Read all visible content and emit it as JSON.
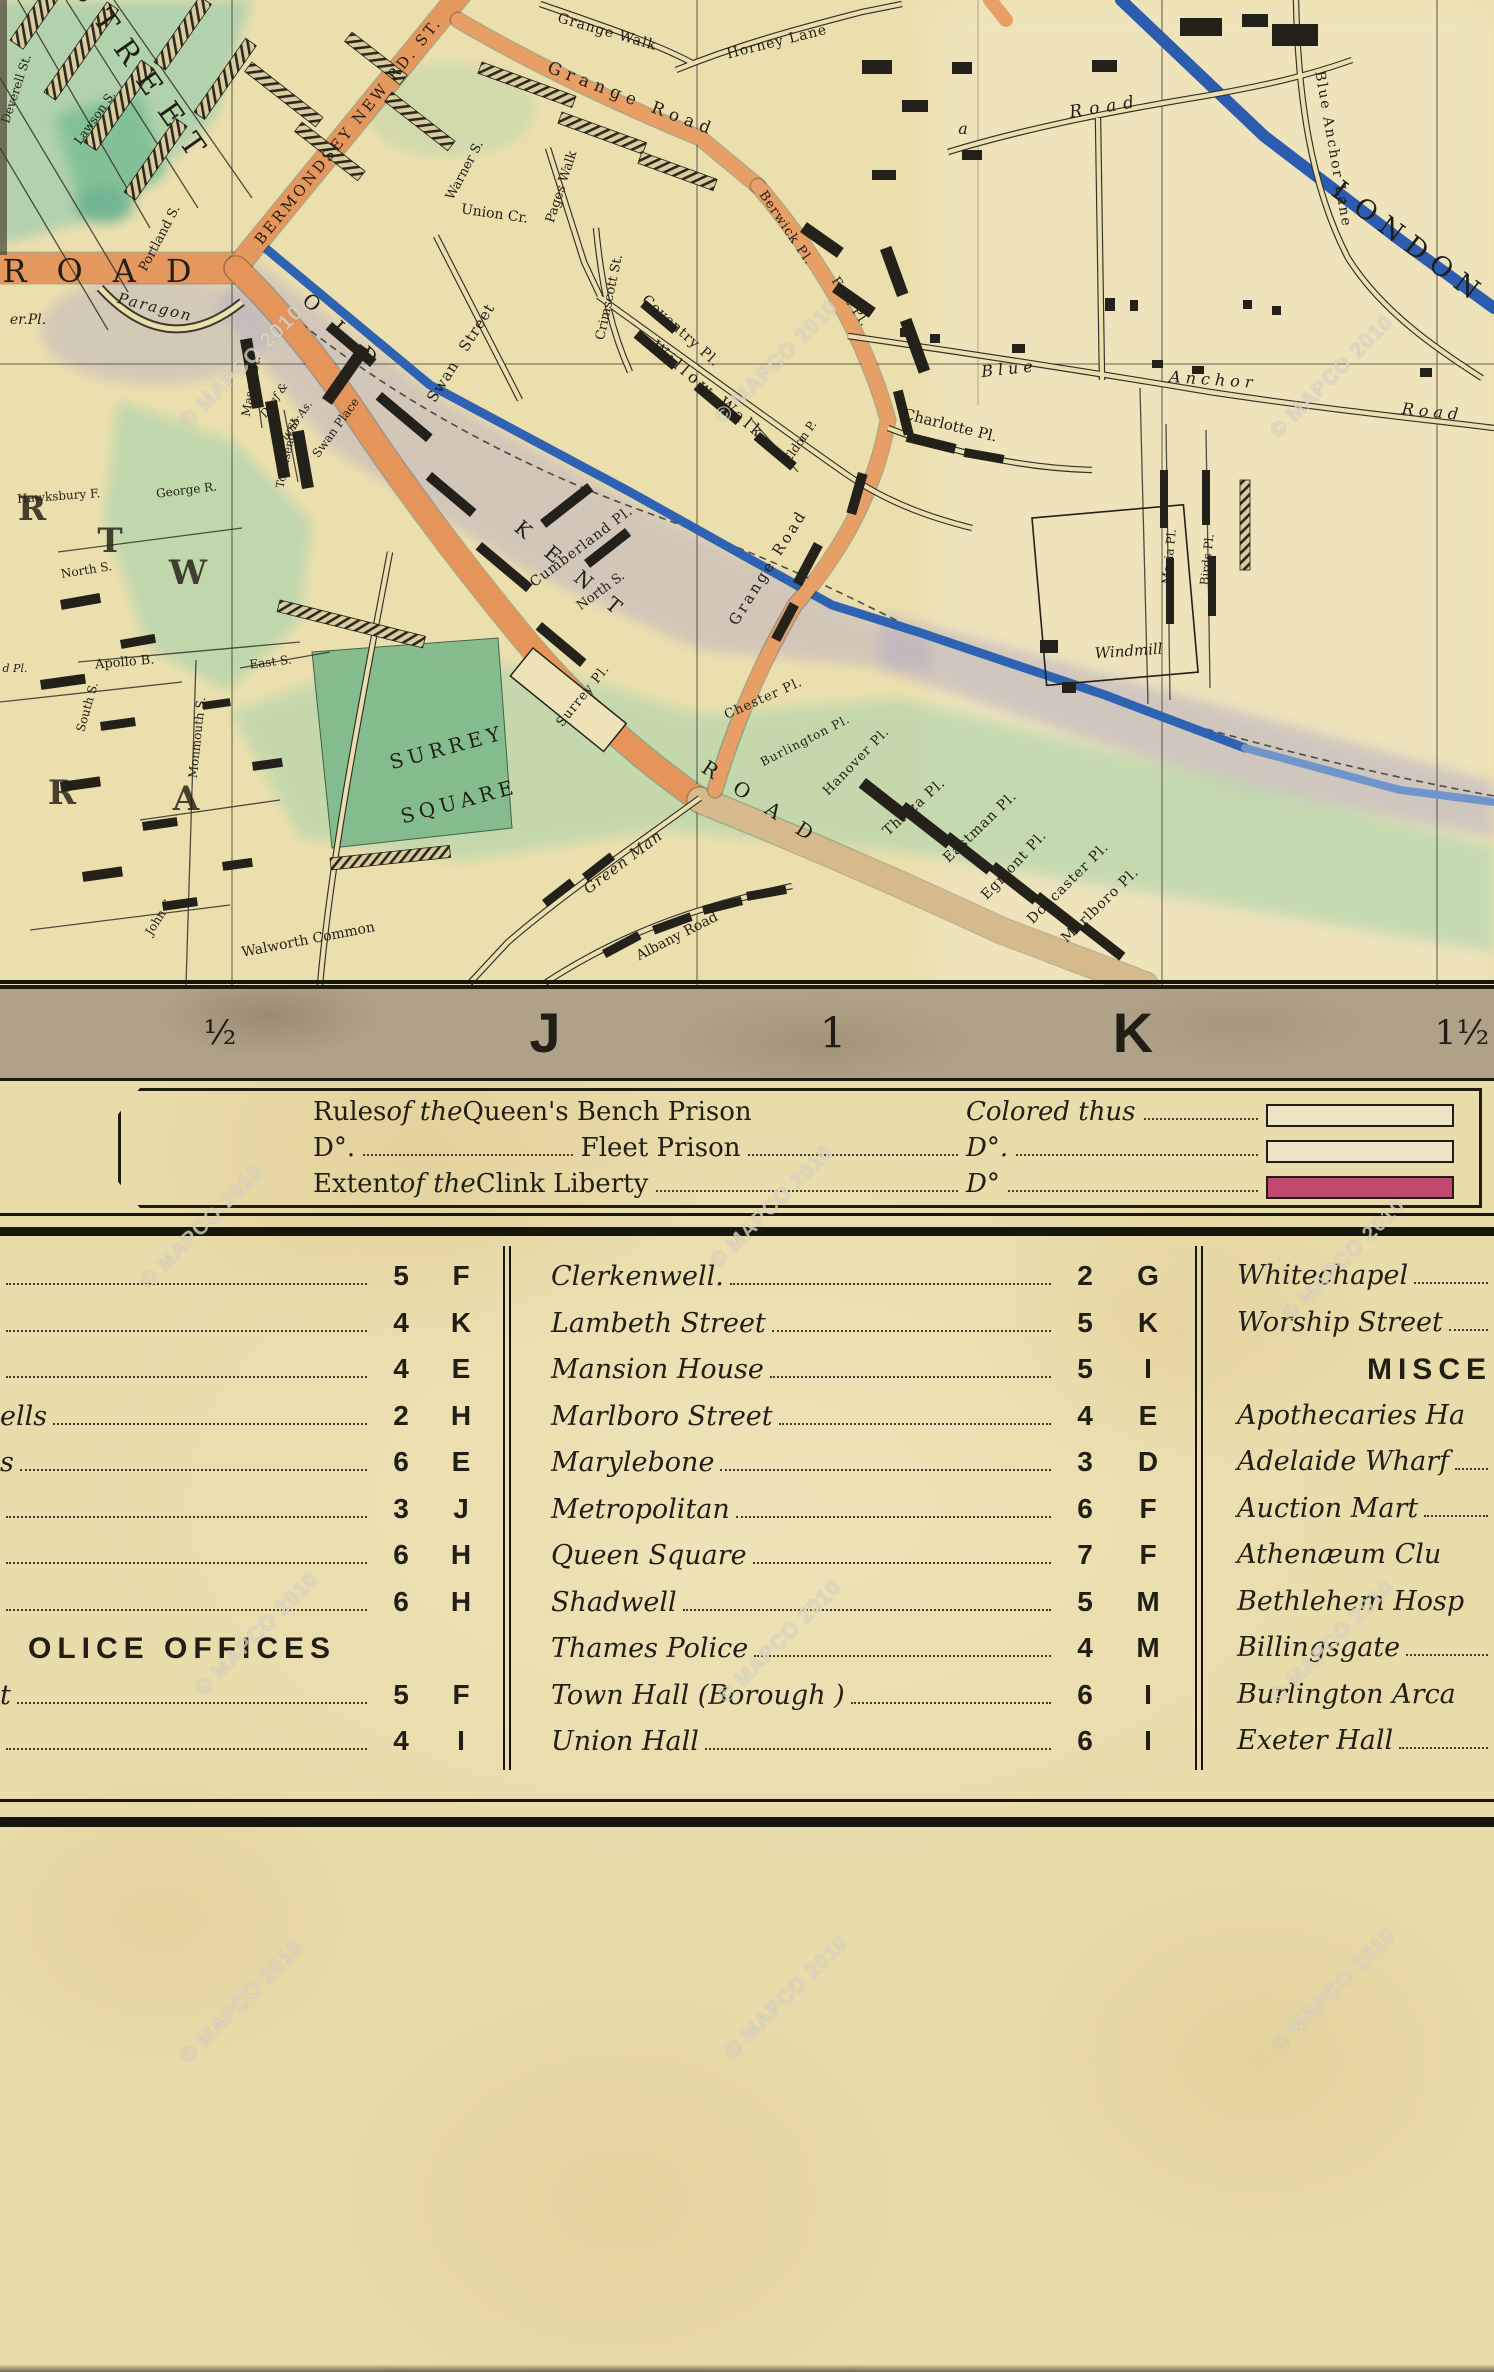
{
  "watermark_text": "© MAPCO 2010",
  "watermarks": [
    {
      "x": 160,
      "y": 355
    },
    {
      "x": 695,
      "y": 350
    },
    {
      "x": 1250,
      "y": 365
    },
    {
      "x": 120,
      "y": 1215
    },
    {
      "x": 690,
      "y": 1195
    },
    {
      "x": 1262,
      "y": 1248
    },
    {
      "x": 175,
      "y": 1622
    },
    {
      "x": 698,
      "y": 1630
    },
    {
      "x": 1250,
      "y": 1630
    },
    {
      "x": 160,
      "y": 1990
    },
    {
      "x": 705,
      "y": 1985
    },
    {
      "x": 1252,
      "y": 1978
    }
  ],
  "colors": {
    "paper": "#e9dcab",
    "map_paper": "#ecdfae",
    "road_orange": "#e5985e",
    "road_tan": "#d6ba8c",
    "canal_blue": "#2e62b2",
    "green": "#b5d6ab",
    "lavender": "#b7afc2",
    "band_gray": "#b0a288",
    "clink_crimson": "#c1486e",
    "ink": "#211e15"
  },
  "map": {
    "labels": [
      [
        "STREET",
        135,
        80,
        55,
        30,
        16,
        ""
      ],
      [
        "ROAD",
        112,
        282,
        0,
        32,
        30,
        ""
      ],
      [
        "er.Pl.",
        28,
        324,
        0,
        14,
        0,
        "it"
      ],
      [
        "Paragon",
        154,
        312,
        14,
        15,
        2,
        "it"
      ],
      [
        "Union Cr.",
        494,
        218,
        8,
        14,
        0,
        ""
      ],
      [
        "Warner S.",
        468,
        172,
        -62,
        13,
        0,
        ""
      ],
      [
        "Portland S.",
        163,
        240,
        -62,
        13,
        0,
        ""
      ],
      [
        "Lawson S.",
        98,
        120,
        -55,
        12,
        0,
        ""
      ],
      [
        "Deverell St.",
        20,
        90,
        -72,
        12,
        0,
        ""
      ],
      [
        "BERMONDSEY NEW RD. ST.",
        352,
        134,
        -51,
        15,
        3,
        ""
      ],
      [
        "Grange Walk",
        606,
        36,
        16,
        14,
        1,
        ""
      ],
      [
        "Horney Lane",
        778,
        46,
        -14,
        14,
        1,
        ""
      ],
      [
        "Grange Road",
        630,
        104,
        21,
        17,
        6,
        ""
      ],
      [
        "Pages Walk",
        565,
        188,
        -72,
        13,
        0,
        ""
      ],
      [
        "Swan",
        447,
        384,
        -58,
        15,
        1,
        ""
      ],
      [
        "Street",
        481,
        330,
        -58,
        15,
        1,
        ""
      ],
      [
        "Crimscott St.",
        613,
        298,
        -78,
        13,
        0,
        ""
      ],
      [
        "Coventry Pl.",
        678,
        334,
        42,
        14,
        1,
        ""
      ],
      [
        "Willow Walk",
        705,
        394,
        40,
        16,
        4,
        ""
      ],
      [
        "Berwick Pl.",
        783,
        230,
        56,
        13,
        1,
        ""
      ],
      [
        "Fort Pl.",
        847,
        304,
        56,
        13,
        1,
        ""
      ],
      [
        "Grange Road",
        772,
        570,
        -58,
        15,
        3,
        ""
      ],
      [
        "Cumberland Pl.",
        584,
        550,
        -37,
        14,
        1,
        ""
      ],
      [
        "North S.",
        603,
        594,
        -36,
        13,
        0,
        ""
      ],
      [
        "Eldon P.",
        803,
        444,
        -55,
        12,
        0,
        ""
      ],
      [
        "a",
        963,
        134,
        0,
        16,
        0,
        "it"
      ],
      [
        "Road",
        1106,
        112,
        -9,
        17,
        7,
        "it"
      ],
      [
        "Blue",
        1010,
        374,
        -6,
        16,
        5,
        "it"
      ],
      [
        "Anchor",
        1213,
        385,
        4,
        16,
        5,
        "it"
      ],
      [
        "Road",
        1432,
        417,
        6,
        16,
        5,
        "it"
      ],
      [
        "Blue Anchor Lane",
        1329,
        150,
        80,
        14,
        2,
        ""
      ],
      [
        "LONDON",
        1404,
        250,
        37,
        27,
        9,
        ""
      ],
      [
        "Charlotte Pl.",
        949,
        430,
        14,
        15,
        0,
        ""
      ],
      [
        "Maria Pl.",
        1173,
        557,
        -84,
        12,
        0,
        ""
      ],
      [
        "Birds Pl.",
        1211,
        560,
        -84,
        12,
        0,
        ""
      ],
      [
        "Windmill",
        1129,
        656,
        -4,
        15,
        0,
        "it"
      ],
      [
        "Mason St.",
        255,
        387,
        -80,
        12,
        0,
        ""
      ],
      [
        "Deaf &",
        277,
        402,
        -55,
        11,
        0,
        "it"
      ],
      [
        "Dumb As.",
        297,
        426,
        -55,
        11,
        0,
        "it"
      ],
      [
        "Townsend St.",
        291,
        452,
        -78,
        11,
        0,
        ""
      ],
      [
        "Swan Place",
        339,
        430,
        -54,
        12,
        0,
        ""
      ],
      [
        "OLD",
        344,
        342,
        43,
        20,
        24,
        ""
      ],
      [
        "KENT",
        573,
        580,
        40,
        20,
        24,
        ""
      ],
      [
        "ROAD",
        763,
        812,
        33,
        20,
        22,
        ""
      ],
      [
        "Surrey Pl.",
        586,
        698,
        -51,
        13,
        1,
        ""
      ],
      [
        "SURREY",
        449,
        754,
        -15,
        20,
        5,
        ""
      ],
      [
        "SQUARE",
        461,
        808,
        -15,
        20,
        5,
        ""
      ],
      [
        "Green Man",
        626,
        866,
        -37,
        15,
        1,
        "it"
      ],
      [
        "Chester Pl.",
        765,
        702,
        -24,
        13,
        1,
        ""
      ],
      [
        "Burlington Pl.",
        807,
        744,
        -27,
        12,
        1,
        ""
      ],
      [
        "Hanover Pl.",
        859,
        764,
        -46,
        13,
        1,
        ""
      ],
      [
        "Thirza Pl.",
        917,
        810,
        -42,
        14,
        1,
        ""
      ],
      [
        "Eastman Pl.",
        983,
        830,
        -44,
        14,
        1,
        ""
      ],
      [
        "Egmont Pl.",
        1017,
        868,
        -47,
        14,
        1,
        ""
      ],
      [
        "Doncaster Pl.",
        1071,
        886,
        -45,
        14,
        1,
        ""
      ],
      [
        "Marlboro Pl.",
        1103,
        908,
        -44,
        14,
        1,
        ""
      ],
      [
        "Albany Road",
        679,
        940,
        -27,
        14,
        0,
        ""
      ],
      [
        "Walworth Common",
        309,
        944,
        -11,
        14,
        0,
        ""
      ],
      [
        "Monmouth S.",
        201,
        738,
        -84,
        12,
        0,
        ""
      ],
      [
        "South S.",
        91,
        708,
        -74,
        12,
        0,
        ""
      ],
      [
        "Apollo B.",
        125,
        666,
        -5,
        13,
        0,
        ""
      ],
      [
        "John S.",
        163,
        918,
        -58,
        12,
        0,
        ""
      ],
      [
        "North S.",
        87,
        574,
        -9,
        12,
        0,
        ""
      ],
      [
        "East S.",
        271,
        666,
        -7,
        12,
        0,
        ""
      ],
      [
        "d Pl.",
        15,
        672,
        0,
        11,
        0,
        "it"
      ],
      [
        "Hawksbury F.",
        59,
        500,
        -4,
        12,
        0,
        ""
      ],
      [
        "George R.",
        187,
        494,
        -7,
        12,
        0,
        ""
      ],
      [
        "R",
        32,
        520,
        0,
        34,
        0,
        "big"
      ],
      [
        "T",
        110,
        552,
        0,
        34,
        0,
        "big"
      ],
      [
        "W",
        188,
        584,
        0,
        34,
        0,
        "big"
      ],
      [
        "R",
        62,
        804,
        0,
        34,
        0,
        "big"
      ],
      [
        "A",
        186,
        810,
        0,
        34,
        0,
        "big"
      ]
    ]
  },
  "scale_bar": {
    "items": [
      {
        "label": "½",
        "x": 220,
        "kind": "frac"
      },
      {
        "label": "J",
        "x": 545,
        "kind": "letter"
      },
      {
        "label": "1",
        "x": 833,
        "kind": "num"
      },
      {
        "label": "K",
        "x": 1133,
        "kind": "letter"
      },
      {
        "label": "1½",
        "x": 1462,
        "kind": "frac"
      }
    ]
  },
  "legend": {
    "rows": [
      {
        "c1": [
          {
            "t": "Rules "
          },
          {
            "t": "of the ",
            "i": true
          },
          {
            "t": "Queen's Bench Prison"
          }
        ],
        "c2": [
          {
            "t": "Colored thus"
          },
          {
            "dots": true
          }
        ],
        "swatch": "",
        "swatch_filled": false
      },
      {
        "c1": [
          {
            "t": "D°."
          },
          {
            "dots": true
          },
          {
            "t": "Fleet Prison"
          },
          {
            "dots": true
          }
        ],
        "c2": [
          {
            "t": "D°."
          },
          {
            "dots": true
          }
        ],
        "swatch": "",
        "swatch_filled": false
      },
      {
        "c1": [
          {
            "t": "Extent "
          },
          {
            "t": "of the ",
            "i": true
          },
          {
            "t": "Clink Liberty"
          },
          {
            "dots": true
          }
        ],
        "c2": [
          {
            "t": "D°"
          },
          {
            "dots": true
          }
        ],
        "swatch": "#c1486e",
        "swatch_filled": true
      }
    ]
  },
  "index": {
    "left_column": [
      {
        "name": "",
        "num": "5",
        "grid": "F"
      },
      {
        "name": "",
        "num": "4",
        "grid": "K"
      },
      {
        "name": "",
        "num": "4",
        "grid": "E"
      },
      {
        "name": "ells",
        "num": "2",
        "grid": "H"
      },
      {
        "name": "s",
        "num": "6",
        "grid": "E"
      },
      {
        "name": "",
        "num": "3",
        "grid": "J"
      },
      {
        "name": "",
        "num": "6",
        "grid": "H"
      },
      {
        "name": "",
        "num": "6",
        "grid": "H"
      },
      {
        "header": "OLICE OFFICES"
      },
      {
        "name": "t",
        "num": "5",
        "grid": "F"
      },
      {
        "name": "",
        "num": "4",
        "grid": "I"
      }
    ],
    "middle_column": [
      {
        "name": "Clerkenwell.",
        "num": "2",
        "grid": "G"
      },
      {
        "name": "Lambeth Street",
        "num": "5",
        "grid": "K"
      },
      {
        "name": "Mansion House",
        "num": "5",
        "grid": "I"
      },
      {
        "name": "Marlboro Street",
        "num": "4",
        "grid": "E"
      },
      {
        "name": "Marylebone",
        "num": "3",
        "grid": "D"
      },
      {
        "name": "Metropolitan",
        "num": "6",
        "grid": "F"
      },
      {
        "name": "Queen Square",
        "num": "7",
        "grid": "F"
      },
      {
        "name": "Shadwell",
        "num": "5",
        "grid": "M"
      },
      {
        "name": "Thames Police",
        "num": "4",
        "grid": "M"
      },
      {
        "name": "Town Hall (Borough )",
        "num": "6",
        "grid": "I"
      },
      {
        "name": "Union Hall",
        "num": "6",
        "grid": "I"
      }
    ],
    "right_column": [
      {
        "name": "Whitechapel",
        "dots": true
      },
      {
        "name": "Worship Street",
        "dots": true
      },
      {
        "header": "MISCE"
      },
      {
        "name": "Apothecaries Ha",
        "dots": false
      },
      {
        "name": "Adelaide Wharf",
        "dots": true
      },
      {
        "name": "Auction Mart",
        "dots": true
      },
      {
        "name": "Athenæum Clu",
        "dots": false
      },
      {
        "name": "Bethlehem Hosp",
        "dots": false
      },
      {
        "name": "Billingsgate",
        "dots": true
      },
      {
        "name": "Burlington Arca",
        "dots": false
      },
      {
        "name": "Exeter Hall",
        "dots": true
      }
    ]
  }
}
